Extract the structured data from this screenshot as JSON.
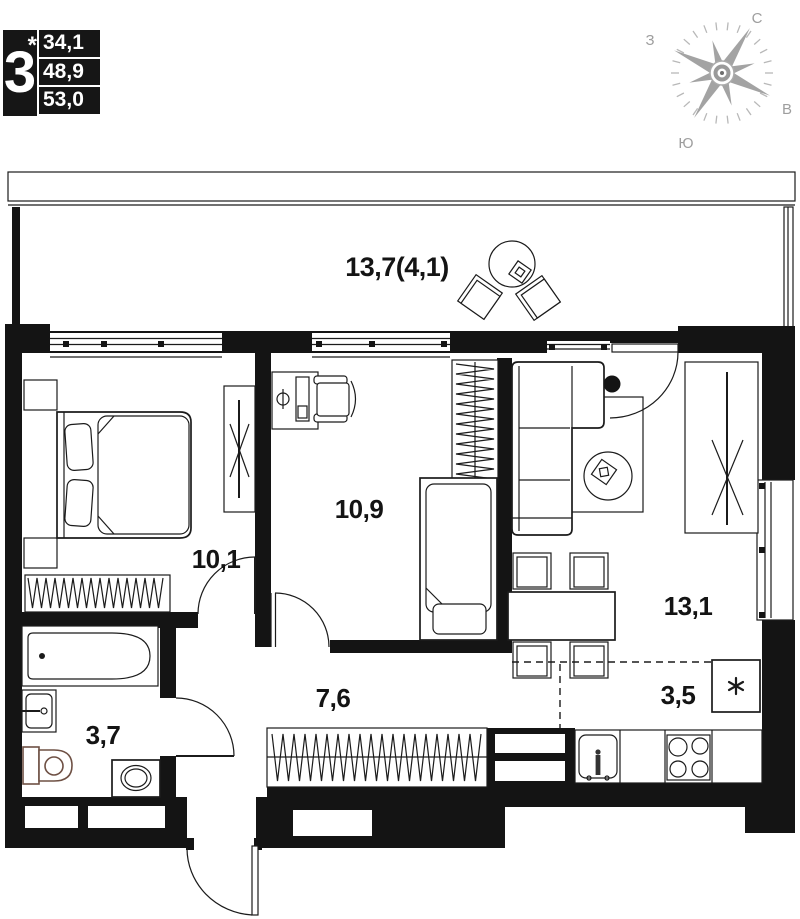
{
  "unit_card": {
    "rooms": "3",
    "note": "*",
    "area1": "34,1",
    "area2": "48,9",
    "area3": "53,0"
  },
  "compass": {
    "n": "С",
    "w": "З",
    "e": "В",
    "s": "Ю"
  },
  "plan": {
    "balcony": "13,7(4,1)",
    "bedroom": "10,1",
    "child_room": "10,9",
    "living": "13,1",
    "hall": "7,6",
    "bathroom": "3,7",
    "kitchen": "3,5"
  },
  "icons": {
    "fridge": "snowflake-asterisk",
    "compass": "wind-rose"
  },
  "colors": {
    "wall": "#141414",
    "line": "#1b1b1b",
    "compass": "#a3a3a3",
    "sanitary": "#6e5044"
  }
}
